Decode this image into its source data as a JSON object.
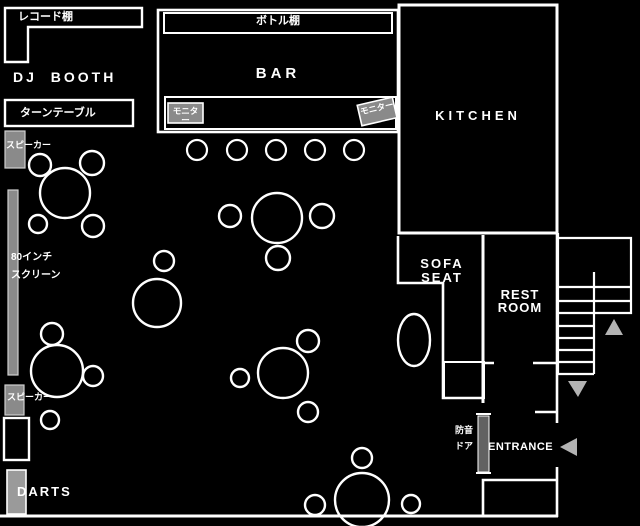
{
  "title": "club floor plan",
  "colors": {
    "background": "#000000",
    "wall": "#ffffff",
    "equipment_gray": "#8a8a8a",
    "door_gray": "#626262",
    "arrow_gray": "#b3b3b3"
  },
  "labels": {
    "record_shelf": "レコード棚",
    "dj_booth": "DJ BOOTH",
    "turntable": "ターンテーブル",
    "speaker_top": "スピーカー",
    "screen_line1": "80インチ",
    "screen_line2": "スクリーン",
    "speaker_bottom": "スピーカー",
    "darts": "DARTS",
    "bottle_shelf": "ボトル棚",
    "bar": "BAR",
    "monitor_left": "モニター",
    "monitor_right": "モニター",
    "kitchen": "KITCHEN",
    "sofa_line1": "SOFA",
    "sofa_line2": "SEAT",
    "restroom_line1": "REST",
    "restroom_line2": "ROOM",
    "entrance": "ENTRANCE",
    "door_line1": "防音",
    "door_line2": "ドア"
  }
}
